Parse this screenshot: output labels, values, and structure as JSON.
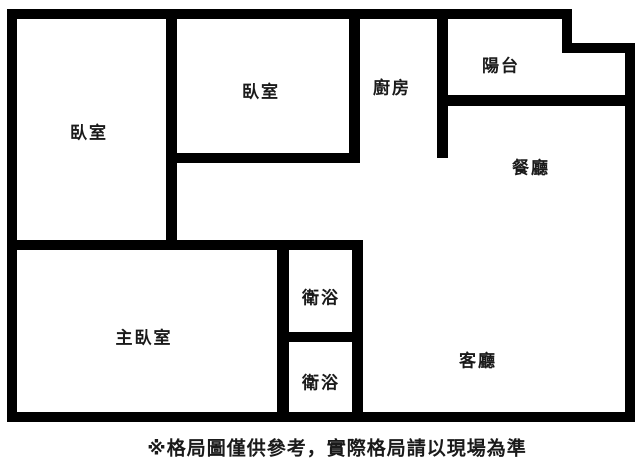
{
  "floorplan": {
    "background_color": "#ffffff",
    "wall_color": "#000000",
    "text_color": "#1a1a1a",
    "rooms": [
      {
        "id": "bedroom-left",
        "label": "臥室",
        "cx": 89,
        "cy": 131
      },
      {
        "id": "bedroom-top",
        "label": "臥室",
        "cx": 261,
        "cy": 90
      },
      {
        "id": "kitchen",
        "label": "廚房",
        "cx": 392,
        "cy": 86
      },
      {
        "id": "balcony",
        "label": "陽台",
        "cx": 501,
        "cy": 64
      },
      {
        "id": "dining-room",
        "label": "餐廳",
        "cx": 531,
        "cy": 166
      },
      {
        "id": "master-bedroom",
        "label": "主臥室",
        "cx": 144,
        "cy": 336
      },
      {
        "id": "bathroom-top",
        "label": "衛浴",
        "cx": 321,
        "cy": 296
      },
      {
        "id": "bathroom-bottom",
        "label": "衛浴",
        "cx": 321,
        "cy": 381
      },
      {
        "id": "living-room",
        "label": "客廳",
        "cx": 478,
        "cy": 359
      }
    ],
    "walls": [
      {
        "name": "outer-top",
        "x": 7,
        "y": 9,
        "w": 565,
        "h": 10
      },
      {
        "name": "outer-notch-vertical",
        "x": 562,
        "y": 9,
        "w": 10,
        "h": 44
      },
      {
        "name": "outer-notch-horizontal",
        "x": 562,
        "y": 43,
        "w": 73,
        "h": 10
      },
      {
        "name": "outer-right",
        "x": 625,
        "y": 43,
        "w": 10,
        "h": 379
      },
      {
        "name": "outer-bottom",
        "x": 7,
        "y": 412,
        "w": 628,
        "h": 10
      },
      {
        "name": "outer-left",
        "x": 7,
        "y": 9,
        "w": 10,
        "h": 413
      },
      {
        "name": "bedroom-divider",
        "x": 166,
        "y": 18,
        "w": 11,
        "h": 232
      },
      {
        "name": "bedroom-top-bottom",
        "x": 166,
        "y": 153,
        "w": 194,
        "h": 10
      },
      {
        "name": "kitchen-left",
        "x": 349,
        "y": 18,
        "w": 11,
        "h": 145
      },
      {
        "name": "kitchen-right",
        "x": 437,
        "y": 18,
        "w": 11,
        "h": 140
      },
      {
        "name": "balcony-bottom",
        "x": 437,
        "y": 95,
        "w": 198,
        "h": 11
      },
      {
        "name": "master-top",
        "x": 7,
        "y": 240,
        "w": 356,
        "h": 10
      },
      {
        "name": "bathroom-left",
        "x": 277,
        "y": 240,
        "w": 12,
        "h": 182
      },
      {
        "name": "bathroom-divider",
        "x": 277,
        "y": 332,
        "w": 86,
        "h": 10
      },
      {
        "name": "bathroom-right",
        "x": 352,
        "y": 240,
        "w": 11,
        "h": 182
      }
    ],
    "caption": {
      "text": "※格局圖僅供參考，實際格局請以現場為準",
      "cx": 337,
      "cy": 447
    }
  }
}
